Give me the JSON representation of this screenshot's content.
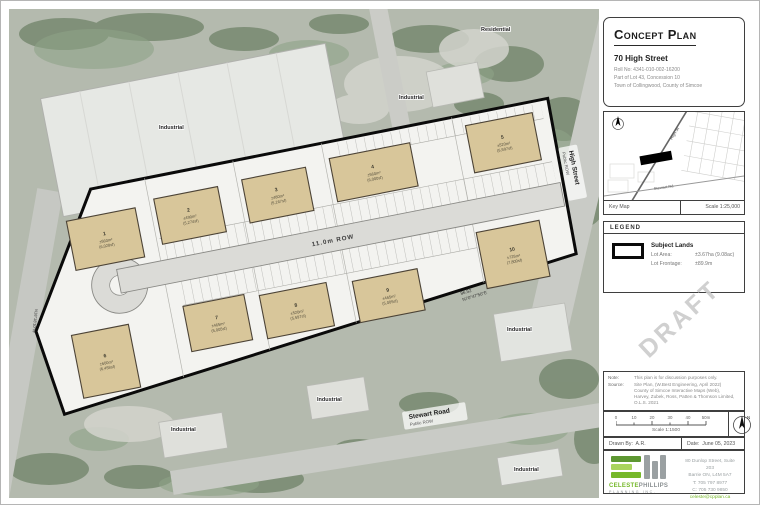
{
  "sheet": {
    "title_block": {
      "title": "Concept Plan",
      "address": "70 High Street",
      "roll": "Roll No: 4341-010-002-16200",
      "legal": "Part of Lot 43, Concession 10",
      "municipality": "Town of Collingwood, County of Simcoe"
    },
    "key_map": {
      "label": "Key Map",
      "scale": "Scale 1:25,000",
      "road_main": "High St",
      "road_cross": "Stewart Rd"
    },
    "legend": {
      "header": "LEGEND",
      "subject_lands": "Subject Lands",
      "lot_area_label": "Lot Area:",
      "lot_area_value": "±3.67ha (9.08ac)",
      "frontage_label": "Lot Frontage:",
      "frontage_value": "±89.9m"
    },
    "draft_watermark": "DRAFT",
    "notes": {
      "note_label": "Note:",
      "note_text": "This plan is for discussion purposes only.",
      "source_label": "Source:",
      "source_line1": "Site Plan, (W.Best Engineering, April 2022)",
      "source_line2": "County of Simcoe Interactive Maps (Web),",
      "source_line3": "Harvey, Zubek, Ross, Patten & Thomson Limited,",
      "source_line4": "O.L.S. 2021"
    },
    "scale_bar": {
      "ticks": [
        "0",
        "10",
        "20",
        "30",
        "40",
        "50m"
      ],
      "label": "Scale 1:1500",
      "north": "N"
    },
    "credits": {
      "drawn_label": "Drawn By:",
      "drawn_value": "A.R.",
      "date_label": "Date:",
      "date_value": "June 05, 2023"
    },
    "firm": {
      "name_first": "CELESTE",
      "name_last": "PHILLIPS",
      "name_sub": "PLANNING INC.",
      "address1": "80 Dunlop Street, Suite 203",
      "address2": "Barrie ON, L4M 5A7",
      "phone": "T: 705 797 8977",
      "cell": "C: 705 730 9850",
      "email": "celeste@cpplan.ca"
    }
  },
  "plan": {
    "row_label": "11.0m ROW",
    "bearing_dist": "86.52",
    "bearing": "N70°47'50\"E",
    "bearing_left": "N16°18'10\"W",
    "street_main": "High Street",
    "street_main_sub": "Public ROW",
    "street_south": "Stewart Road",
    "street_south_sub": "Public ROW",
    "buildings": [
      {
        "num": "1",
        "area": "±560m²",
        "sf": "(6,028sf)"
      },
      {
        "num": "2",
        "area": "±490m²",
        "sf": "(5,274sf)"
      },
      {
        "num": "3",
        "area": "±480m²",
        "sf": "(5,167sf)"
      },
      {
        "num": "4",
        "area": "±560m²",
        "sf": "(6,000sf)"
      },
      {
        "num": "5",
        "area": "±520m²",
        "sf": "(5,597sf)"
      },
      {
        "num": "6",
        "area": "±600m²",
        "sf": "(6,458sf)"
      },
      {
        "num": "7",
        "area": "±465m²",
        "sf": "(5,005sf)"
      },
      {
        "num": "8",
        "area": "±520m²",
        "sf": "(5,597sf)"
      },
      {
        "num": "9",
        "area": "±465m²",
        "sf": "(5,005sf)"
      },
      {
        "num": "10",
        "area": "±725m²",
        "sf": "(7,800sf)"
      }
    ]
  },
  "aerial": {
    "labels": [
      {
        "text": "Residential"
      },
      {
        "text": "Industrial"
      },
      {
        "text": "Industrial"
      },
      {
        "text": "Industrial"
      },
      {
        "text": "Industrial"
      },
      {
        "text": "Industrial"
      },
      {
        "text": "Industrial"
      }
    ]
  },
  "colors": {
    "accent_green": "#76b82a",
    "logo_gray": "#9aa0a2",
    "building_fill": "#d8c69a",
    "draft_gray": "#cbcbcb",
    "boundary_black": "#0a0a0a"
  }
}
